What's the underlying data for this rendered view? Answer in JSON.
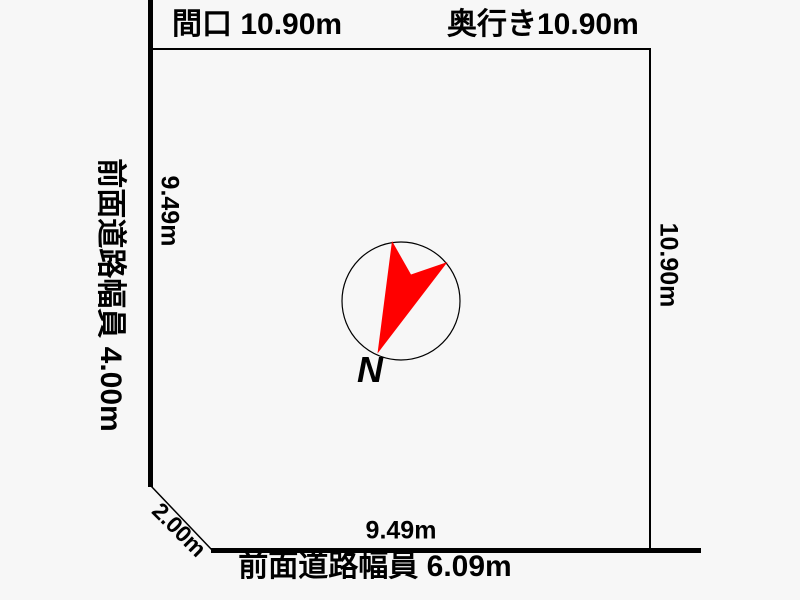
{
  "diagram": {
    "type": "land-plot-survey",
    "colors": {
      "background": "#f7f7f7",
      "line": "#000000",
      "arrow": "#ff0000"
    },
    "labels": {
      "frontage_top": "間口 10.90m",
      "depth_top": "奥行き10.90m",
      "road_left": "前面道路幅員 4.00m",
      "road_bottom": "前面道路幅員 6.09m",
      "dim_left": "9.49m",
      "dim_right": "10.90m",
      "dim_bottom": "9.49m",
      "dim_corner": "2.00m"
    },
    "compass": {
      "north_letter": "N",
      "arrow_color": "#ff0000"
    }
  }
}
